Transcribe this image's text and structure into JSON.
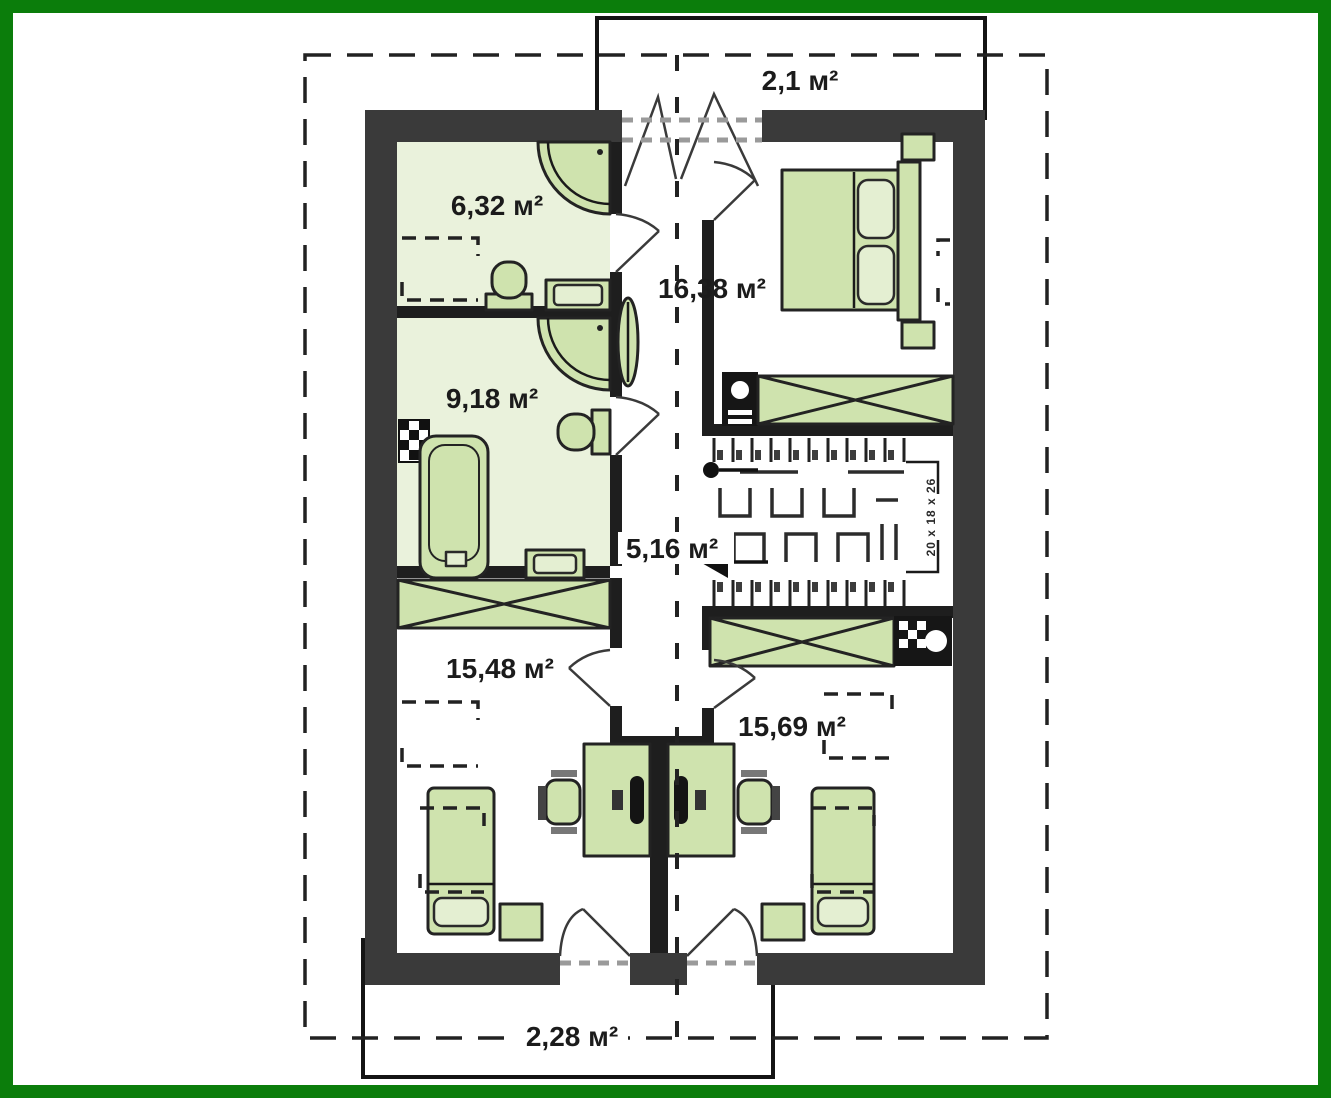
{
  "colors": {
    "frame": "#0b7d0b",
    "wall": "#3a3a3a",
    "furn": "#cfe3ae",
    "furn-light": "#e4efd2",
    "floor": "#eaf2dc"
  },
  "plan": {
    "balcony_top": "2,1 м²",
    "bath_small": "6,32 м²",
    "bedroom": "16,38 м²",
    "bath_big": "9,18 м²",
    "hallway": "5,16 м²",
    "room_left": "15,48 м²",
    "room_right": "15,69 м²",
    "balcony_bottom": "2,28 м²",
    "stair_note": "20 x 18 x 26"
  }
}
